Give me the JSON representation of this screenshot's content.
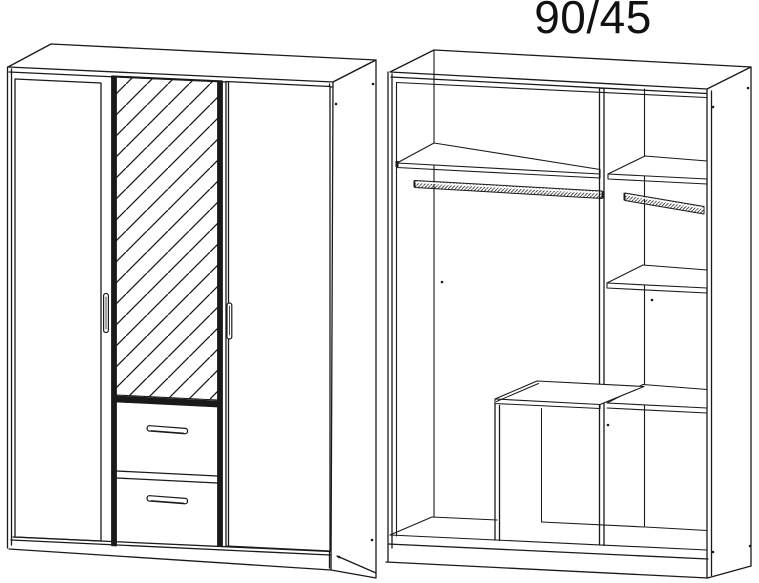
{
  "title": "90/45",
  "colors": {
    "line": "#1a1a1a",
    "background": "#ffffff"
  }
}
